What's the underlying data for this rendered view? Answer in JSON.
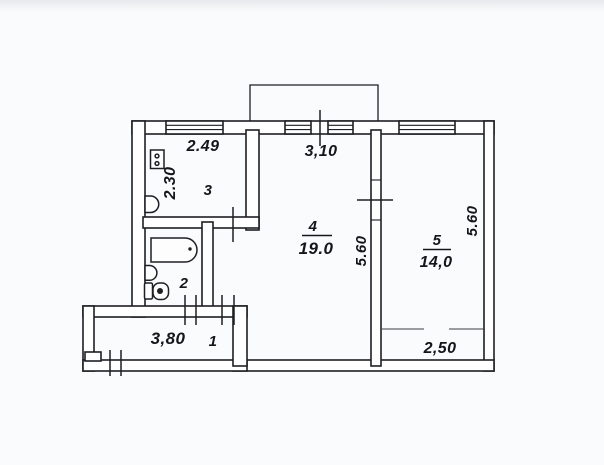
{
  "plan": {
    "colors": {
      "paper": "#fafbfc",
      "line": "#1e1f24",
      "text": "#15161a"
    },
    "rooms": {
      "hall": {
        "number": "1",
        "width": "3,80"
      },
      "bathroom": {
        "number": "2"
      },
      "kitchen": {
        "number": "3",
        "width": "2.49",
        "depth": "2.30"
      },
      "living": {
        "number": "4",
        "area": "19.0",
        "window_width": "3,10",
        "depth": "5.60"
      },
      "bedroom": {
        "number": "5",
        "area": "14,0",
        "depth": "5.60",
        "width": "2,50"
      }
    }
  }
}
